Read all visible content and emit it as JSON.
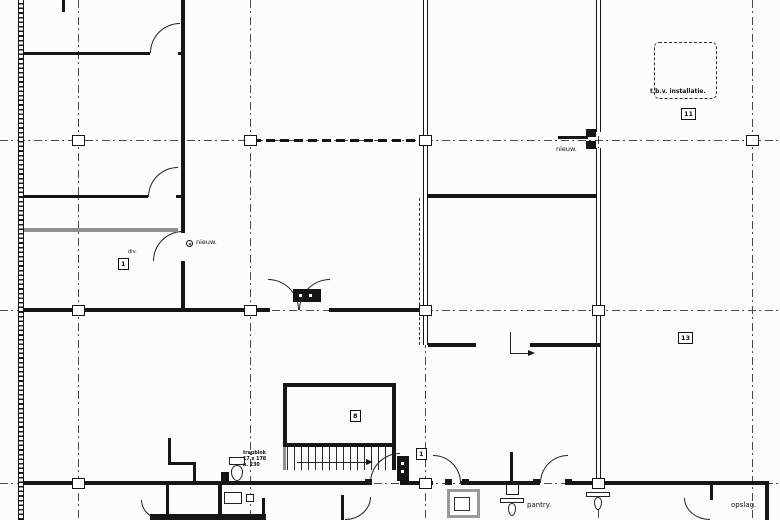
{
  "meta": {
    "width": 780,
    "height": 520,
    "background": "#fcfcfc",
    "ink": "#161616",
    "gray_wall": "#8f8f8f",
    "grid_color": "#4a4a4a",
    "drawing_type": "architectural floor plan"
  },
  "plan": {
    "gridlines": {
      "vertical_x": [
        78,
        250,
        425,
        598,
        752
      ],
      "horizontal_y": [
        140,
        310,
        483
      ]
    },
    "heavy_dashed_line": {
      "x": 252,
      "y": 139,
      "w": 170
    },
    "columns": [
      [
        78,
        140
      ],
      [
        250,
        140
      ],
      [
        425,
        140
      ],
      [
        752,
        140
      ],
      [
        78,
        310
      ],
      [
        250,
        310
      ],
      [
        425,
        310
      ],
      [
        598,
        310
      ],
      [
        78,
        483
      ],
      [
        425,
        483
      ],
      [
        598,
        483
      ],
      [
        512,
        489
      ]
    ],
    "walls": [
      {
        "x": 18,
        "y": 0,
        "w": 6,
        "h": 520,
        "style": "hatch"
      },
      {
        "x": 62,
        "y": 0,
        "w": 3,
        "h": 12,
        "style": "solid"
      },
      {
        "x": 24,
        "y": 52,
        "w": 126,
        "h": 3,
        "style": "solid"
      },
      {
        "x": 178,
        "y": 52,
        "w": 7,
        "h": 3,
        "style": "solid"
      },
      {
        "x": 24,
        "y": 195,
        "w": 124,
        "h": 3,
        "style": "solid"
      },
      {
        "x": 176,
        "y": 195,
        "w": 9,
        "h": 3,
        "style": "solid"
      },
      {
        "x": 24,
        "y": 228,
        "w": 154,
        "h": 4,
        "style": "gray"
      },
      {
        "x": 181,
        "y": 0,
        "w": 4,
        "h": 233,
        "style": "solid"
      },
      {
        "x": 181,
        "y": 261,
        "w": 4,
        "h": 51,
        "style": "solid"
      },
      {
        "x": 24,
        "y": 308,
        "w": 246,
        "h": 4,
        "style": "solid"
      },
      {
        "x": 329,
        "y": 308,
        "w": 99,
        "h": 4,
        "style": "solid"
      },
      {
        "x": 423,
        "y": 0,
        "w": 5,
        "h": 345,
        "style": "double"
      },
      {
        "x": 419,
        "y": 198,
        "w": 2,
        "h": 147,
        "style": "dashedv"
      },
      {
        "x": 428,
        "y": 194,
        "w": 172,
        "h": 4,
        "style": "solid"
      },
      {
        "x": 596,
        "y": 0,
        "w": 5,
        "h": 132,
        "style": "double"
      },
      {
        "x": 596,
        "y": 148,
        "w": 5,
        "h": 337,
        "style": "double"
      },
      {
        "x": 428,
        "y": 343,
        "w": 48,
        "h": 4,
        "style": "solid"
      },
      {
        "x": 530,
        "y": 343,
        "w": 70,
        "h": 4,
        "style": "solid"
      },
      {
        "x": 765,
        "y": 481,
        "w": 4,
        "h": 39,
        "style": "solid"
      },
      {
        "x": 24,
        "y": 481,
        "w": 196,
        "h": 4,
        "style": "solid"
      },
      {
        "x": 220,
        "y": 481,
        "w": 150,
        "h": 4,
        "style": "solid"
      },
      {
        "x": 400,
        "y": 481,
        "w": 33,
        "h": 4,
        "style": "solid"
      },
      {
        "x": 461,
        "y": 481,
        "w": 79,
        "h": 4,
        "style": "solid"
      },
      {
        "x": 568,
        "y": 481,
        "w": 199,
        "h": 4,
        "style": "solid"
      },
      {
        "x": 168,
        "y": 438,
        "w": 3,
        "h": 27,
        "style": "solid"
      },
      {
        "x": 168,
        "y": 462,
        "w": 28,
        "h": 3,
        "style": "solid"
      },
      {
        "x": 193,
        "y": 462,
        "w": 3,
        "h": 22,
        "style": "solid"
      },
      {
        "x": 510,
        "y": 452,
        "w": 3,
        "h": 31,
        "style": "solid"
      },
      {
        "x": 710,
        "y": 485,
        "w": 3,
        "h": 15,
        "style": "solid"
      },
      {
        "x": 341,
        "y": 495,
        "w": 3,
        "h": 25,
        "style": "solid"
      },
      {
        "x": 166,
        "y": 485,
        "w": 3,
        "h": 35,
        "style": "solid"
      },
      {
        "x": 218,
        "y": 485,
        "w": 4,
        "h": 35,
        "style": "solid"
      },
      {
        "x": 150,
        "y": 514,
        "w": 116,
        "h": 6,
        "style": "solid"
      },
      {
        "x": 262,
        "y": 498,
        "w": 3,
        "h": 22,
        "style": "solid"
      },
      {
        "x": 283,
        "y": 383,
        "w": 113,
        "h": 4,
        "style": "solid"
      },
      {
        "x": 283,
        "y": 383,
        "w": 4,
        "h": 64,
        "style": "solid"
      },
      {
        "x": 392,
        "y": 383,
        "w": 4,
        "h": 64,
        "style": "solid"
      },
      {
        "x": 283,
        "y": 443,
        "w": 113,
        "h": 4,
        "style": "solid"
      },
      {
        "x": 283,
        "y": 447,
        "w": 3,
        "h": 23,
        "style": "gray"
      },
      {
        "x": 392,
        "y": 447,
        "w": 4,
        "h": 23,
        "style": "solid"
      },
      {
        "x": 558,
        "y": 136,
        "w": 30,
        "h": 3,
        "style": "solid"
      }
    ],
    "doors": [
      {
        "x": 150,
        "y": 23,
        "w": 30,
        "h": 30,
        "corner": "tl"
      },
      {
        "x": 148,
        "y": 167,
        "w": 30,
        "h": 30,
        "corner": "tl"
      },
      {
        "x": 153,
        "y": 231,
        "w": 30,
        "h": 30,
        "corner": "tl"
      },
      {
        "x": 268,
        "y": 279,
        "w": 31,
        "h": 31,
        "corner": "tr"
      },
      {
        "x": 299,
        "y": 279,
        "w": 31,
        "h": 31,
        "corner": "tl"
      },
      {
        "x": 370,
        "y": 453,
        "w": 30,
        "h": 30,
        "corner": "tl"
      },
      {
        "x": 433,
        "y": 455,
        "w": 28,
        "h": 28,
        "corner": "tr"
      },
      {
        "x": 540,
        "y": 455,
        "w": 28,
        "h": 28,
        "corner": "tl"
      },
      {
        "x": 141,
        "y": 500,
        "w": 22,
        "h": 20,
        "corner": "bl"
      },
      {
        "x": 345,
        "y": 497,
        "w": 26,
        "h": 23,
        "corner": "br"
      },
      {
        "x": 684,
        "y": 498,
        "w": 26,
        "h": 22,
        "corner": "bl"
      }
    ],
    "door_jambs": [
      [
        586,
        129,
        10,
        8
      ],
      [
        586,
        141,
        10,
        8
      ],
      [
        365,
        479,
        7,
        6
      ],
      [
        400,
        479,
        7,
        6
      ],
      [
        445,
        479,
        7,
        6
      ],
      [
        462,
        479,
        7,
        6
      ],
      [
        533,
        479,
        7,
        6
      ],
      [
        565,
        479,
        7,
        6
      ]
    ],
    "stair": {
      "treads": {
        "x": 287,
        "y": 447,
        "w": 105,
        "h": 23,
        "step": 7
      },
      "arrow": {
        "x": 297,
        "y": 462,
        "len": 69
      }
    },
    "section_arrow": {
      "x": 510,
      "y1": 332,
      "y2": 353,
      "x2": 528
    },
    "installation_outline": {
      "x": 654,
      "y": 42,
      "w": 63,
      "h": 57
    },
    "fixtures": {
      "door_tag": {
        "x": 293,
        "y": 289,
        "w": 28,
        "h": 13
      },
      "cabinet": {
        "x": 397,
        "y": 456,
        "w": 12,
        "h": 25
      },
      "wc": {
        "tank": {
          "x": 229,
          "y": 457,
          "w": 16,
          "h": 8
        },
        "bowl": {
          "x": 231,
          "y": 465,
          "w": 12,
          "h": 16
        }
      },
      "shaft": {
        "outer": {
          "x": 447,
          "y": 489,
          "w": 33,
          "h": 29
        },
        "inner": {
          "x": 454,
          "y": 497,
          "w": 16,
          "h": 14
        }
      },
      "anchors": [
        {
          "bar": {
            "x": 500,
            "y": 498,
            "w": 24,
            "h": 5
          },
          "drop": {
            "x": 508,
            "y": 503,
            "w": 8,
            "h": 13
          }
        },
        {
          "bar": {
            "x": 586,
            "y": 492,
            "w": 24,
            "h": 5
          },
          "drop": {
            "x": 594,
            "y": 497,
            "w": 8,
            "h": 13
          }
        }
      ],
      "basin": {
        "x": 224,
        "y": 492,
        "w": 18,
        "h": 12
      },
      "small_square": {
        "x": 246,
        "y": 494,
        "w": 8,
        "h": 8
      },
      "black_blob": {
        "x": 221,
        "y": 472,
        "w": 8,
        "h": 11
      }
    },
    "labels": [
      {
        "text": "nieuw.",
        "x": 196,
        "y": 239,
        "size": 6.5,
        "icon": true
      },
      {
        "text": "nieuw.",
        "x": 556,
        "y": 146,
        "size": 6.5
      },
      {
        "text": "pantry.",
        "x": 527,
        "y": 502,
        "size": 7
      },
      {
        "text": "opslag.",
        "x": 731,
        "y": 502,
        "size": 7
      },
      {
        "text": "t.b.v. installatie.",
        "x": 650,
        "y": 89,
        "size": 6,
        "bold": true
      },
      {
        "text": "div.",
        "x": 128,
        "y": 250,
        "size": 5
      },
      {
        "text": "trapblok",
        "x": 243,
        "y": 451,
        "size": 4.8,
        "bold": true
      },
      {
        "text": "17 x 178",
        "x": 243,
        "y": 457,
        "size": 4.8,
        "bold": true
      },
      {
        "text": "a. 230",
        "x": 243,
        "y": 463,
        "size": 4.8,
        "bold": true
      }
    ],
    "room_tags": [
      {
        "text": "1",
        "x": 118,
        "y": 258
      },
      {
        "text": "8",
        "x": 350,
        "y": 410
      },
      {
        "text": "11",
        "x": 681,
        "y": 108
      },
      {
        "text": "13",
        "x": 678,
        "y": 332
      },
      {
        "text": "1",
        "x": 416,
        "y": 448
      }
    ]
  }
}
